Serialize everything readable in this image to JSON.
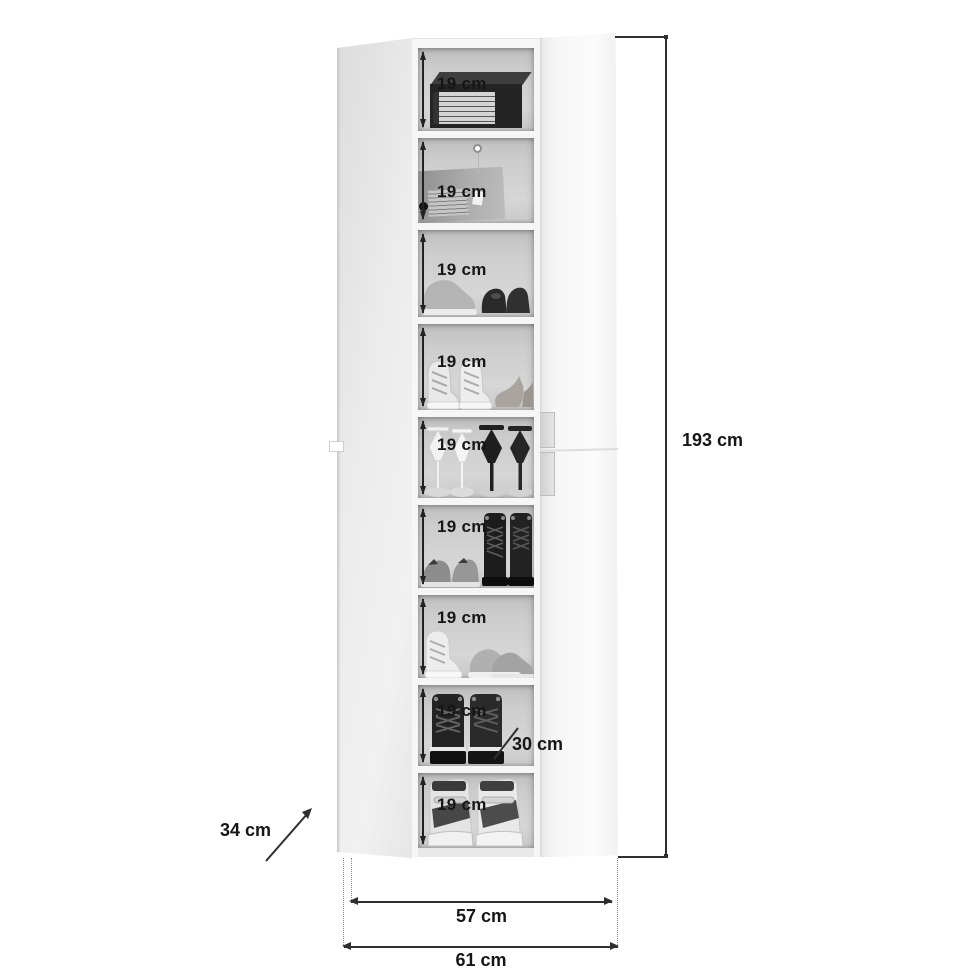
{
  "diagram": {
    "labels": {
      "total_height": "193 cm",
      "inner_width": "57 cm",
      "outer_width": "61 cm",
      "depth": "34 cm",
      "shelf_depth": "30 cm"
    },
    "shelves": [
      {
        "label": "19 cm",
        "content": "dark-shoe-box"
      },
      {
        "label": "19 cm",
        "content": "grey-shoe-box-with-hang-tag"
      },
      {
        "label": "19 cm",
        "content": "sneaker-and-dark-dress-shoes"
      },
      {
        "label": "19 cm",
        "content": "white-high-top-sneakers-and-suede-heels"
      },
      {
        "label": "19 cm",
        "content": "white-and-black-stiletto-heels"
      },
      {
        "label": "19 cm",
        "content": "grey-sneakers-and-black-lace-up-boots"
      },
      {
        "label": "19 cm",
        "content": "white-high-top-and-grey-running-shoes"
      },
      {
        "label": "19 cm",
        "content": "black-platform-lace-up-boots"
      },
      {
        "label": "19 cm",
        "content": "wedge-sneaker-sandals"
      }
    ],
    "colors": {
      "background": "#ffffff",
      "dimension_line": "#2f2f2f",
      "text": "#161616",
      "interior_back": "#cdcdcd",
      "door": "#ededed"
    }
  }
}
